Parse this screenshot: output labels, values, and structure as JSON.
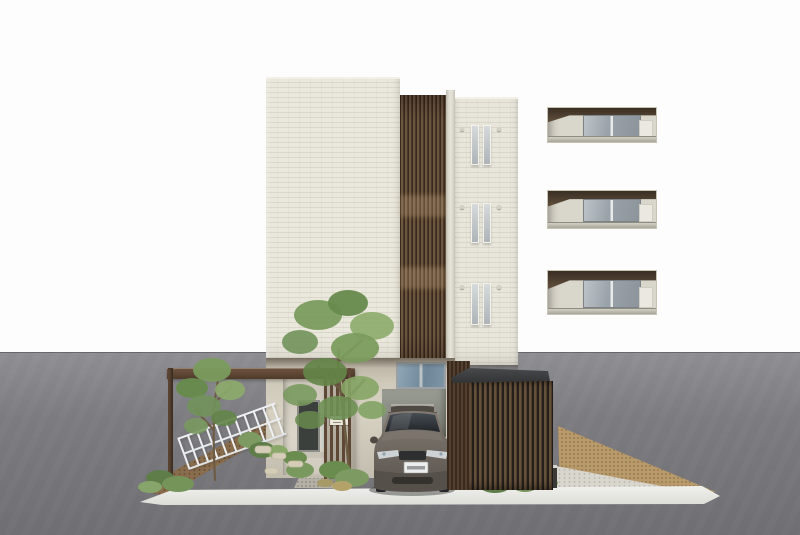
{
  "scene": {
    "type": "architectural-exterior-rendering",
    "description": "Front elevation rendering of a modern low-rise apartment building with cream brick facade, a dark vertical timber louver screen, three recessed balcony floors on the left wing, three pairs of narrow windows on the right wing, landscaped forecourt with two trees, white boundary fence, timber entrance gate screen with an illegible nameplate, a grey SUV parked in the driveway, and a timber-slat bicycle shelter, all set against a white sky and grey asphalt street.",
    "building": {
      "upper_balcony_floors": 3,
      "right_wing_window_pairs": 3,
      "balcony_ac_units": 3
    },
    "objects": [
      "apartment-building",
      "timber-louver-screen",
      "entrance-gate-screen",
      "pergola-beam",
      "white-fence",
      "tree-large",
      "tree-small",
      "shrub-planting",
      "parked-suv",
      "license-plate-illegible",
      "bicycle-shelter",
      "bollard-light",
      "kerb",
      "gravel-strip",
      "mulch-strip",
      "paved-forecourt",
      "asphalt-street",
      "white-sky"
    ]
  },
  "colors": {
    "sky": "#fdfdfe",
    "asphalt-top": "#8e8e92",
    "asphalt-bottom": "#6f6f73",
    "facade": "#eae7dc",
    "louver-mid": "#6d563f",
    "wood": "#4e3a2a",
    "glass": "#8b949a",
    "narrow-glass": "#aeb4b8",
    "transom": "#7e95a6",
    "door": "#3c403d",
    "fence-white": "#eef0f2",
    "curb": "#ddddd8",
    "paving": "#e2d9c5",
    "dirt": "#8a6d4d",
    "gravel": "#b99a6a",
    "shelter-roof": "#303234",
    "car-body": "#6e6760",
    "car-glass": "#2b3034",
    "plate": "#eceded",
    "green-mid": "#7b9c5e",
    "green-dark": "#678a4c",
    "green-light": "#8cab6a"
  }
}
